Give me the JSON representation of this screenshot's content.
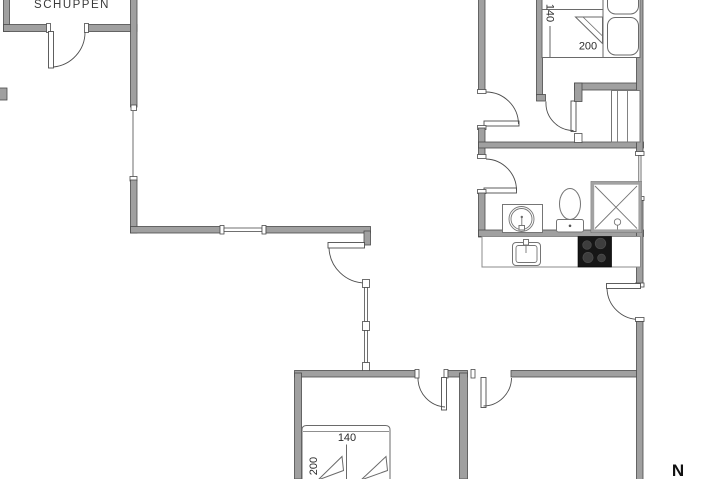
{
  "labels": {
    "shed": "SCHUPPEN",
    "north": "N"
  },
  "beds": {
    "bedroom_top": {
      "width": "140",
      "length": "200"
    },
    "bedroom_bottom": {
      "width": "140",
      "length": "200"
    }
  },
  "fixtures": [
    "washbasin-icon",
    "toilet-icon",
    "shower-icon",
    "kitchen-sink-icon",
    "cooktop-icon",
    "wardrobe-icon",
    "double-bed-icon",
    "pillow-icon",
    "door-swing-icon",
    "window-icon",
    "compass-north"
  ],
  "colors": {
    "wall_fill": "#a0a0a0",
    "wall_edge": "#4a4a4a",
    "line": "#4d4d4d",
    "fixture_line": "#757575",
    "paper": "#ffffff",
    "text": "#2b2b2b",
    "cooktop": "#161616",
    "burner": "#3d3d3d"
  }
}
